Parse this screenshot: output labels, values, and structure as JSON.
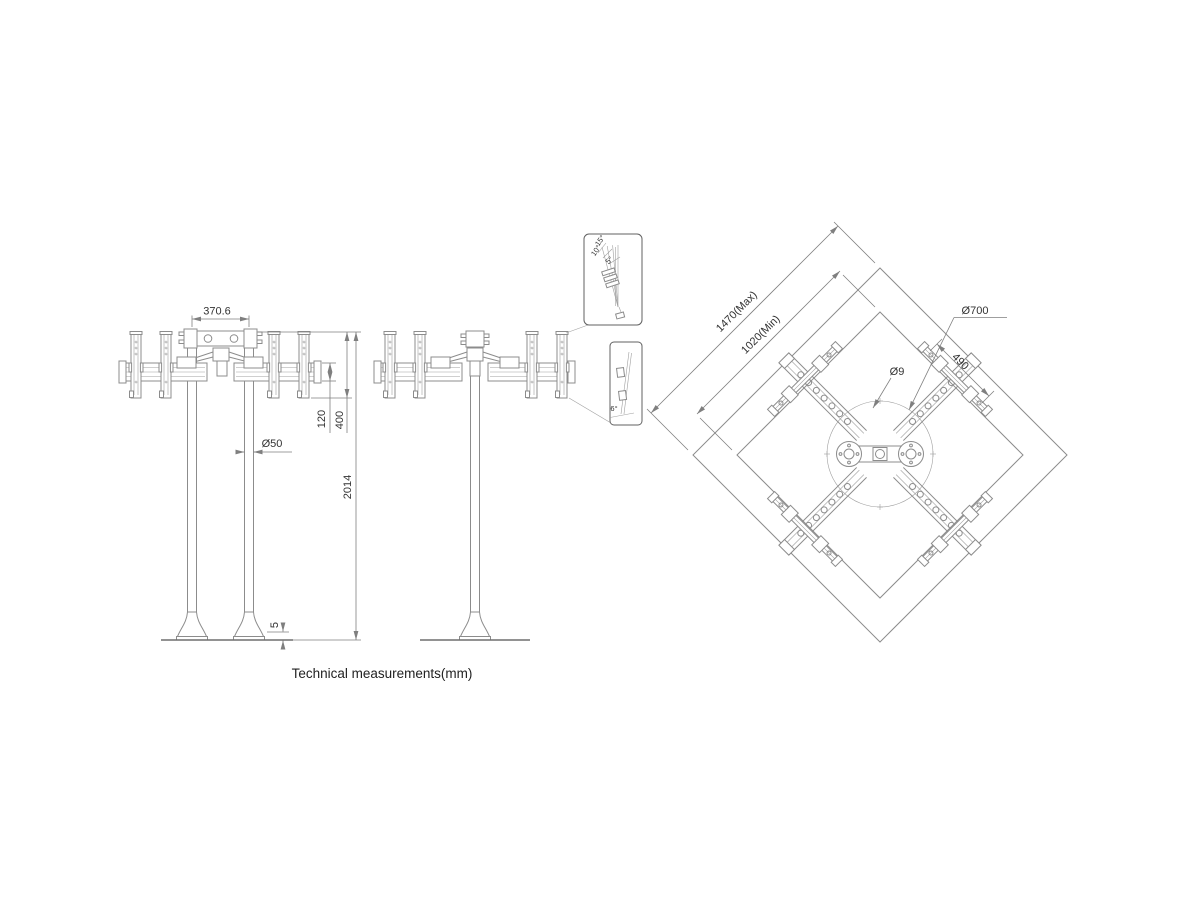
{
  "caption": "Technical measurements(mm)",
  "front_view": {
    "name": "front view",
    "dims": {
      "pole_spacing": "370.6",
      "bracket_height": "120",
      "rail_height": "400",
      "pole_diameter": "Ø50",
      "total_height": "2014",
      "base_plate_thickness": "5"
    }
  },
  "side_view": {
    "name": "side view",
    "tilt_detail": {
      "angles": [
        "15°",
        "10°",
        "5°"
      ]
    },
    "swivel_detail": {
      "angle": "6°"
    }
  },
  "top_view": {
    "name": "top view",
    "dims": {
      "width_max": "1470(Max)",
      "width_min": "1020(Min)",
      "base_diameter": "Ø700",
      "hole_diameter": "Ø9",
      "rail_length": "490"
    }
  },
  "colors": {
    "line": "#8c8c8c",
    "detail": "#606060",
    "dimension": "#7f7f7f",
    "text": "#333333",
    "background": "#ffffff"
  }
}
